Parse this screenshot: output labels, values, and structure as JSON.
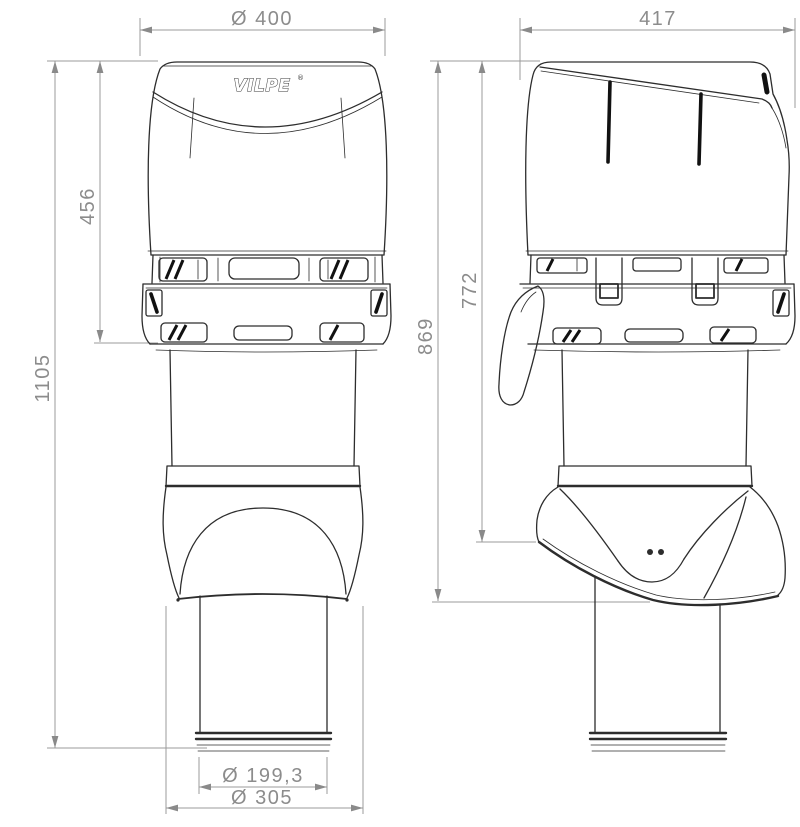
{
  "page": {
    "background": "#ffffff",
    "description": "Technical dimension drawing of a VILPE roof ventilation outlet, front view and side view"
  },
  "brand": {
    "logo": "VILPE",
    "registered": "®"
  },
  "colors": {
    "product_line": "#2d2d2d",
    "dimension_line": "#9b9b9b",
    "dimension_text": "#8c8c8c"
  },
  "front_view": {
    "dim_hood_diameter": "Ø 400",
    "dim_hood_height": "456",
    "dim_total_height": "1105",
    "dim_pipe_diameter": "Ø 199,3",
    "dim_skirt_diameter": "Ø 305"
  },
  "side_view": {
    "dim_width": "417",
    "dim_height_to_skirt_edge": "772",
    "dim_height_overall": "869"
  }
}
